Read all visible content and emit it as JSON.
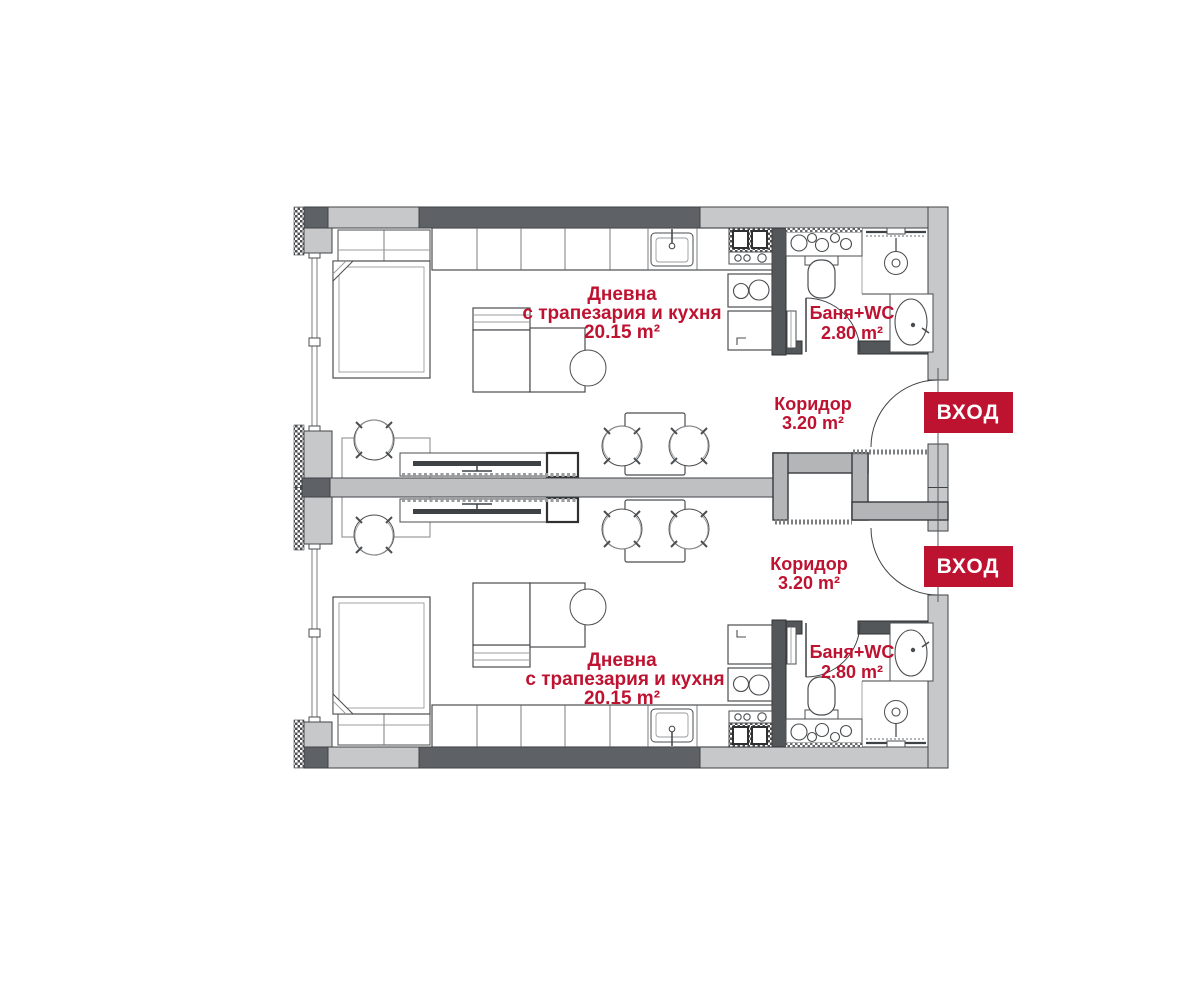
{
  "floor_plan": {
    "colors": {
      "accent_red": "#BE1231",
      "wall_dark": "#5E6165",
      "wall_light": "#C7C8C9",
      "wall_mid_gray": "#B4B5B7",
      "outline": "#3F4245"
    },
    "units": [
      {
        "living_room": {
          "name_line1": "Дневна",
          "name_line2": "с трапезария и кухня",
          "area": "20.15 m²"
        },
        "bathroom": {
          "name": "Баня+WC",
          "area": "2.80 m²"
        },
        "corridor": {
          "name": "Коридор",
          "area": "3.20 m²"
        },
        "entrance_badge": "ВХОД"
      },
      {
        "living_room": {
          "name_line1": "Дневна",
          "name_line2": "с трапезария и кухня",
          "area": "20.15 m²"
        },
        "bathroom": {
          "name": "Баня+WC",
          "area": "2.80 m²"
        },
        "corridor": {
          "name": "Коридор",
          "area": "3.20 m²"
        },
        "entrance_badge": "ВХОД"
      }
    ]
  }
}
